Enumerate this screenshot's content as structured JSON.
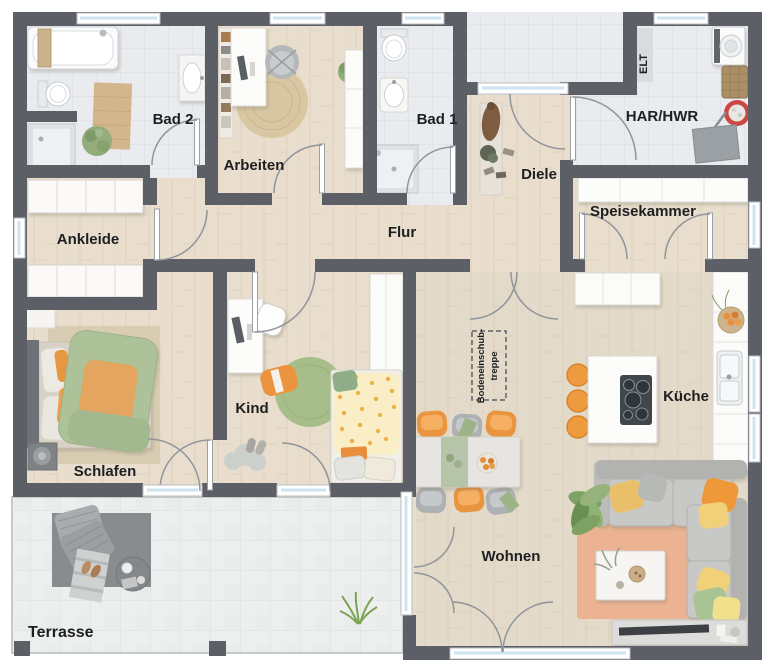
{
  "plan": {
    "type": "floor-plan",
    "language": "de",
    "rooms": {
      "bad2": "Bad 2",
      "arbeiten": "Arbeiten",
      "bad1": "Bad 1",
      "diele": "Diele",
      "elt": "ELT",
      "har_hwr": "HAR/HWR",
      "speisekammer": "Speisekammer",
      "ankleide": "Ankleide",
      "flur": "Flur",
      "schlafen": "Schlafen",
      "kind": "Kind",
      "kueche": "Küche",
      "wohnen": "Wohnen",
      "terrasse": "Terrasse",
      "attic_stairs_line1": "Bodeneinschub-",
      "attic_stairs_line2": "treppe"
    },
    "colors": {
      "wall": "#5c6066",
      "wood_floor": "#e9decd",
      "tile_floor": "#e9ebee",
      "terrace_floor": "#edefee",
      "glass": "#cde3f0",
      "accent_orange": "#ee9a3e",
      "accent_green": "#a8be8a",
      "sofa_gray": "#c8c9c7",
      "rug_salmon": "#ecb392"
    }
  }
}
